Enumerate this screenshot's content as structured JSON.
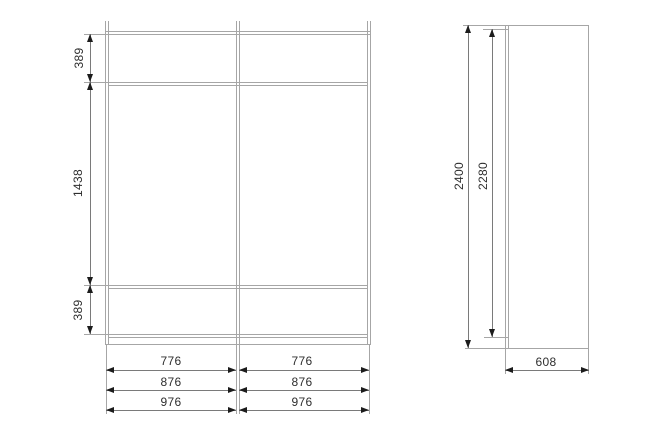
{
  "title": "Wardrobe technical dimension drawing",
  "front_view": {
    "vertical_dims": [
      "389",
      "1438",
      "389"
    ],
    "width_dim_rows": [
      {
        "left": "776",
        "right": "776"
      },
      {
        "left": "876",
        "right": "876"
      },
      {
        "left": "976",
        "right": "976"
      }
    ]
  },
  "side_view": {
    "overall_height": "2400",
    "interior_height": "2280",
    "depth": "608"
  },
  "colors": {
    "line": "#a6a6a6",
    "dim": "#7a7a7a",
    "arrow": "#1c1c1c",
    "text": "#2e2e2e",
    "bg": "#ffffff"
  }
}
